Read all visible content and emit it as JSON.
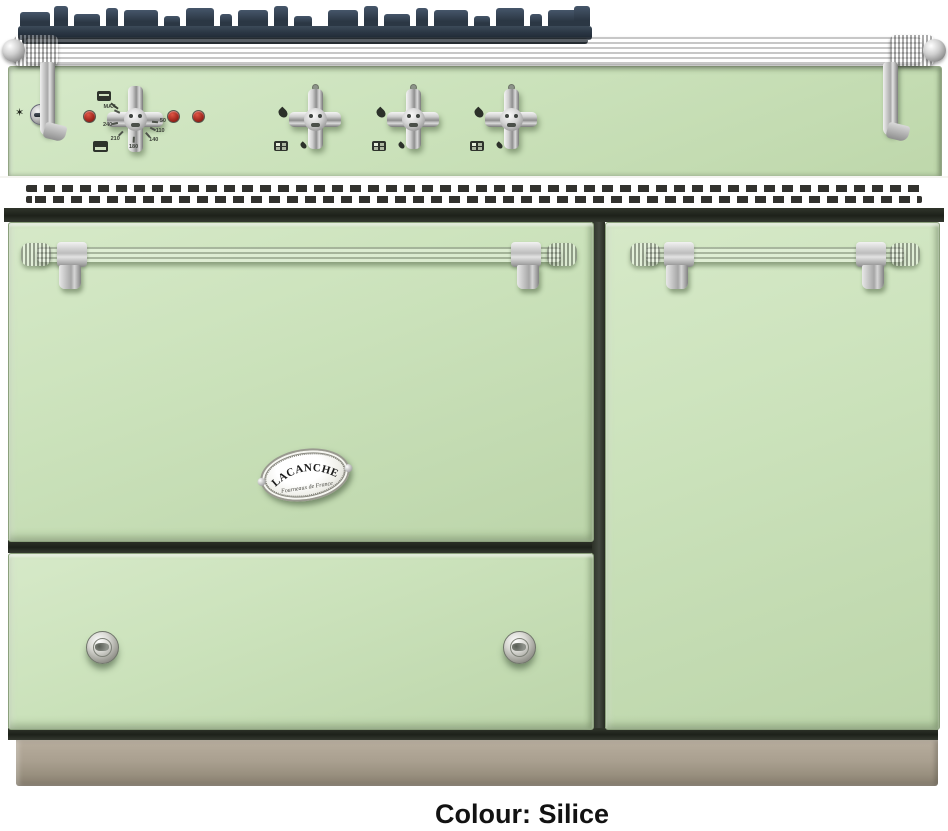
{
  "page": {
    "background_color": "#ffffff",
    "caption": "Colour: Silice"
  },
  "product": {
    "brand": "LACANCHE",
    "badge_tagline": "Fourneaux de France",
    "colour_name": "Silice",
    "colors": {
      "enamel_green": "#cbe2bb",
      "plinth_taupe": "#aaa090",
      "grate_iron": "#2b3744",
      "chrome": "#c9c9c9",
      "indicator_red": "#a52a20"
    }
  },
  "control_panel": {
    "star_icon_glyph": "✶",
    "thermostat": {
      "scale_labels": [
        "MAX",
        "240",
        "210",
        "180",
        "140",
        "110",
        "50"
      ]
    },
    "burner_knob_count": 3,
    "indicator_light_count": 3
  }
}
